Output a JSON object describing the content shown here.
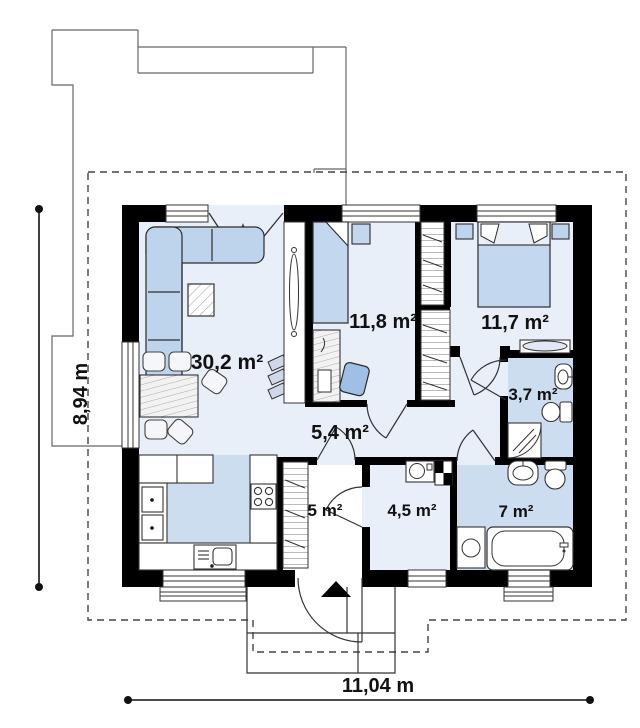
{
  "plan": {
    "title": "single-storey house floor plan",
    "rooms": [
      {
        "id": "living-room-kitchen",
        "area": "30,2 m²"
      },
      {
        "id": "bedroom-1",
        "area": "11,8 m²"
      },
      {
        "id": "bedroom-2",
        "area": "11,7 m²"
      },
      {
        "id": "bathroom-small",
        "area": "3,7 m²"
      },
      {
        "id": "hall",
        "area": "5,4 m²"
      },
      {
        "id": "vestibule",
        "area": "5 m²"
      },
      {
        "id": "utility-room",
        "area": "4,5 m²"
      },
      {
        "id": "bathroom-large",
        "area": "7 m²"
      }
    ],
    "dimensions": {
      "width": "11,04 m",
      "depth": "8,94 m"
    },
    "colors": {
      "wall": "#000000",
      "room_floor": "#e9eff8",
      "wet_floor": "#ccddf0",
      "furniture": "#bed3ec",
      "outline": "#2b2b2b"
    }
  }
}
